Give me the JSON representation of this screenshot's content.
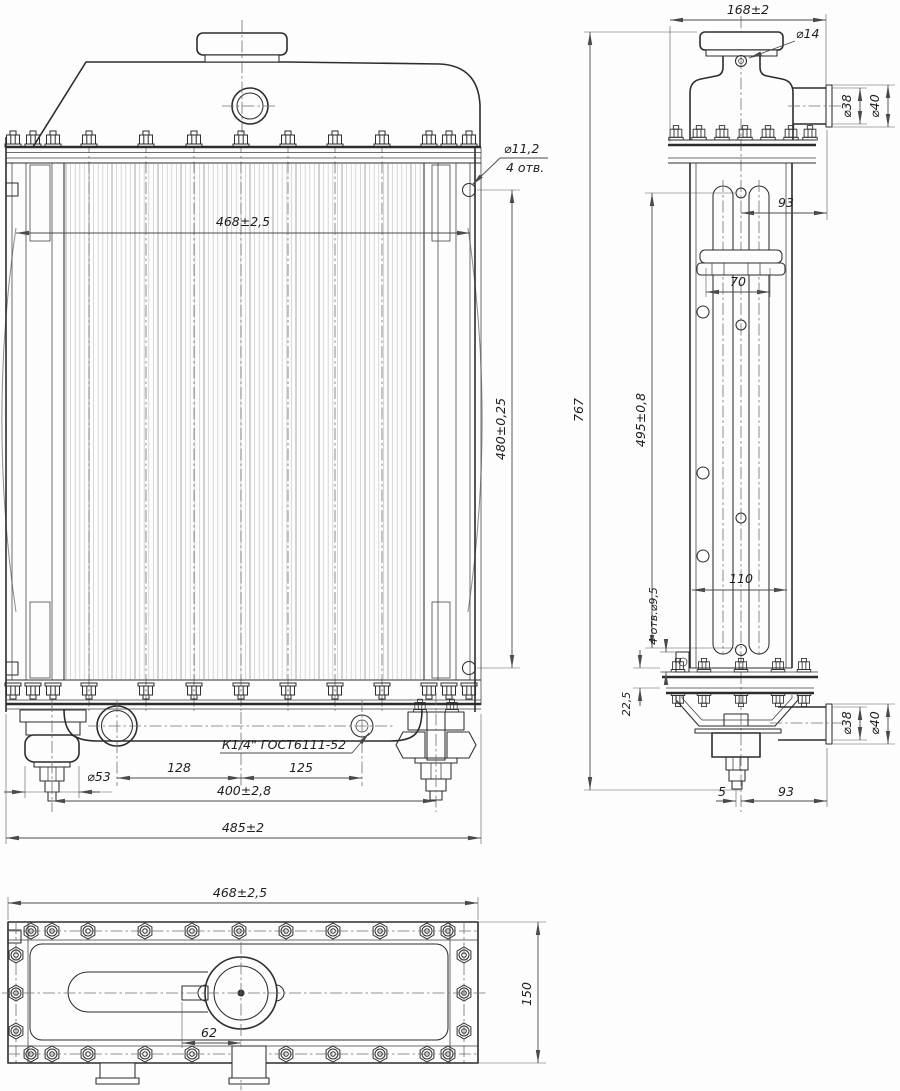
{
  "front": {
    "core_width": "468±2,5",
    "height": "480±0,25",
    "hole_dia": "⌀11,2",
    "hole_qty": "4 отв.",
    "cushion_dia": "⌀53",
    "dim_128": "128",
    "dim_125": "125",
    "mount_span": "400±2,8",
    "overall_width": "485±2",
    "drain_spec": "К1/4\" ГОСТ6111-52"
  },
  "side": {
    "depth": "168±2",
    "cap_screw_dia": "⌀14",
    "pipe_top_inner_dia": "⌀38",
    "pipe_top_outer_dia": "⌀40",
    "dim_93_top": "93",
    "dim_70": "70",
    "overall_height": "767",
    "core_height": "495±0,8",
    "dim_110": "110",
    "mount_holes": "4 отв.⌀9,5",
    "dim_22_5": "22,5",
    "pipe_bottom_inner_dia": "⌀38",
    "pipe_bottom_outer_dia": "⌀40",
    "dim_5": "5",
    "dim_93_bottom": "93"
  },
  "plan": {
    "width": "468±2,5",
    "dim_62": "62",
    "depth": "150"
  }
}
